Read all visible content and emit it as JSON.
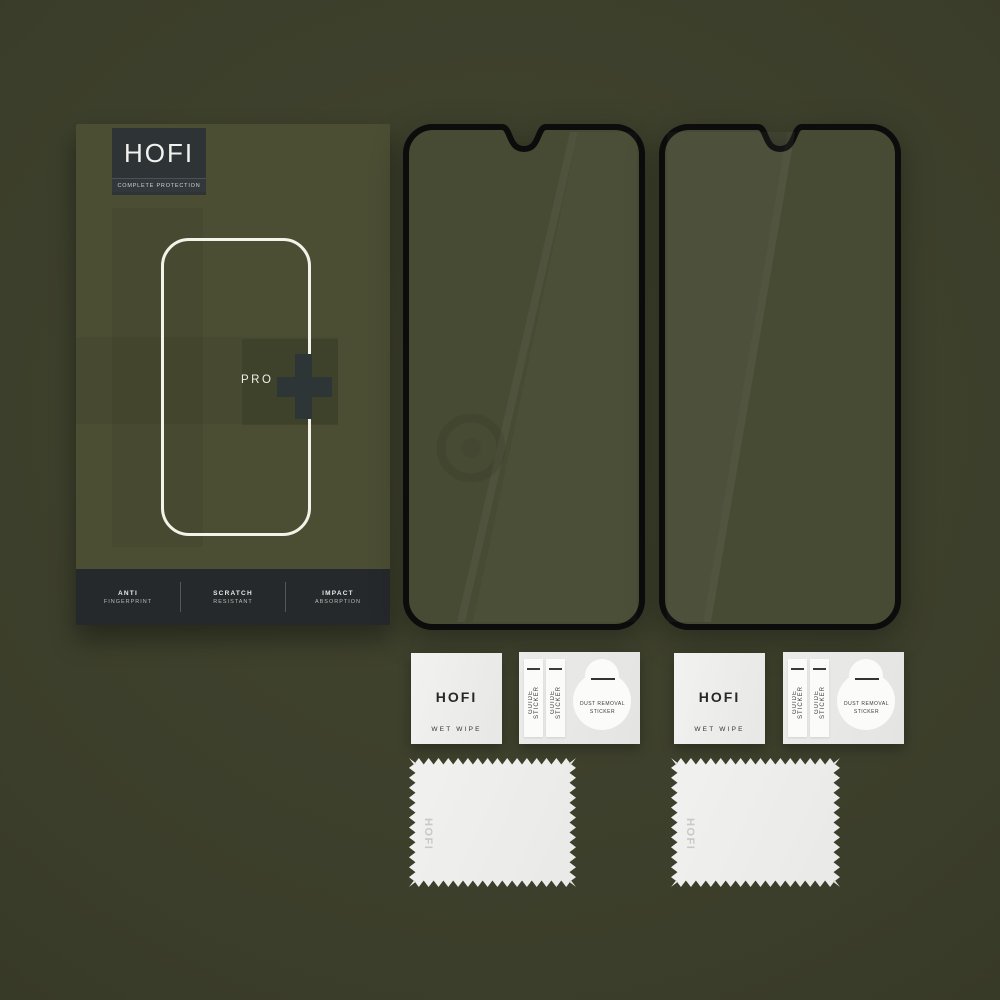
{
  "box": {
    "brand": "HOFI",
    "tagline": "COMPLETE PROTECTION",
    "model": "PRO",
    "plus_icon": "+",
    "features": [
      {
        "line1": "ANTI",
        "line2": "FINGERPRINT"
      },
      {
        "line1": "SCRATCH",
        "line2": "RESISTANT"
      },
      {
        "line1": "IMPACT",
        "line2": "ABSORPTION"
      }
    ]
  },
  "wet_wipe": {
    "brand": "HOFI",
    "label": "WET WIPE"
  },
  "sticker_sheet": {
    "guide_label": "GUIDE STICKER",
    "dust_line1": "DUST REMOVAL",
    "dust_line2": "STICKER"
  },
  "cloth": {
    "brand": "HOFI"
  },
  "colors": {
    "background": "#3b3e2a",
    "box_face": "#4b4e33",
    "logo_panel": "#2e3335",
    "feature_strip": "#26292b",
    "outline_white": "#f5f3e9",
    "plus_mark": "#2e3537",
    "glass_frame": "#0b0c0b",
    "glass_tint": "#484b34",
    "packet_light": "#ededeb",
    "cloth_white": "#efefed"
  }
}
